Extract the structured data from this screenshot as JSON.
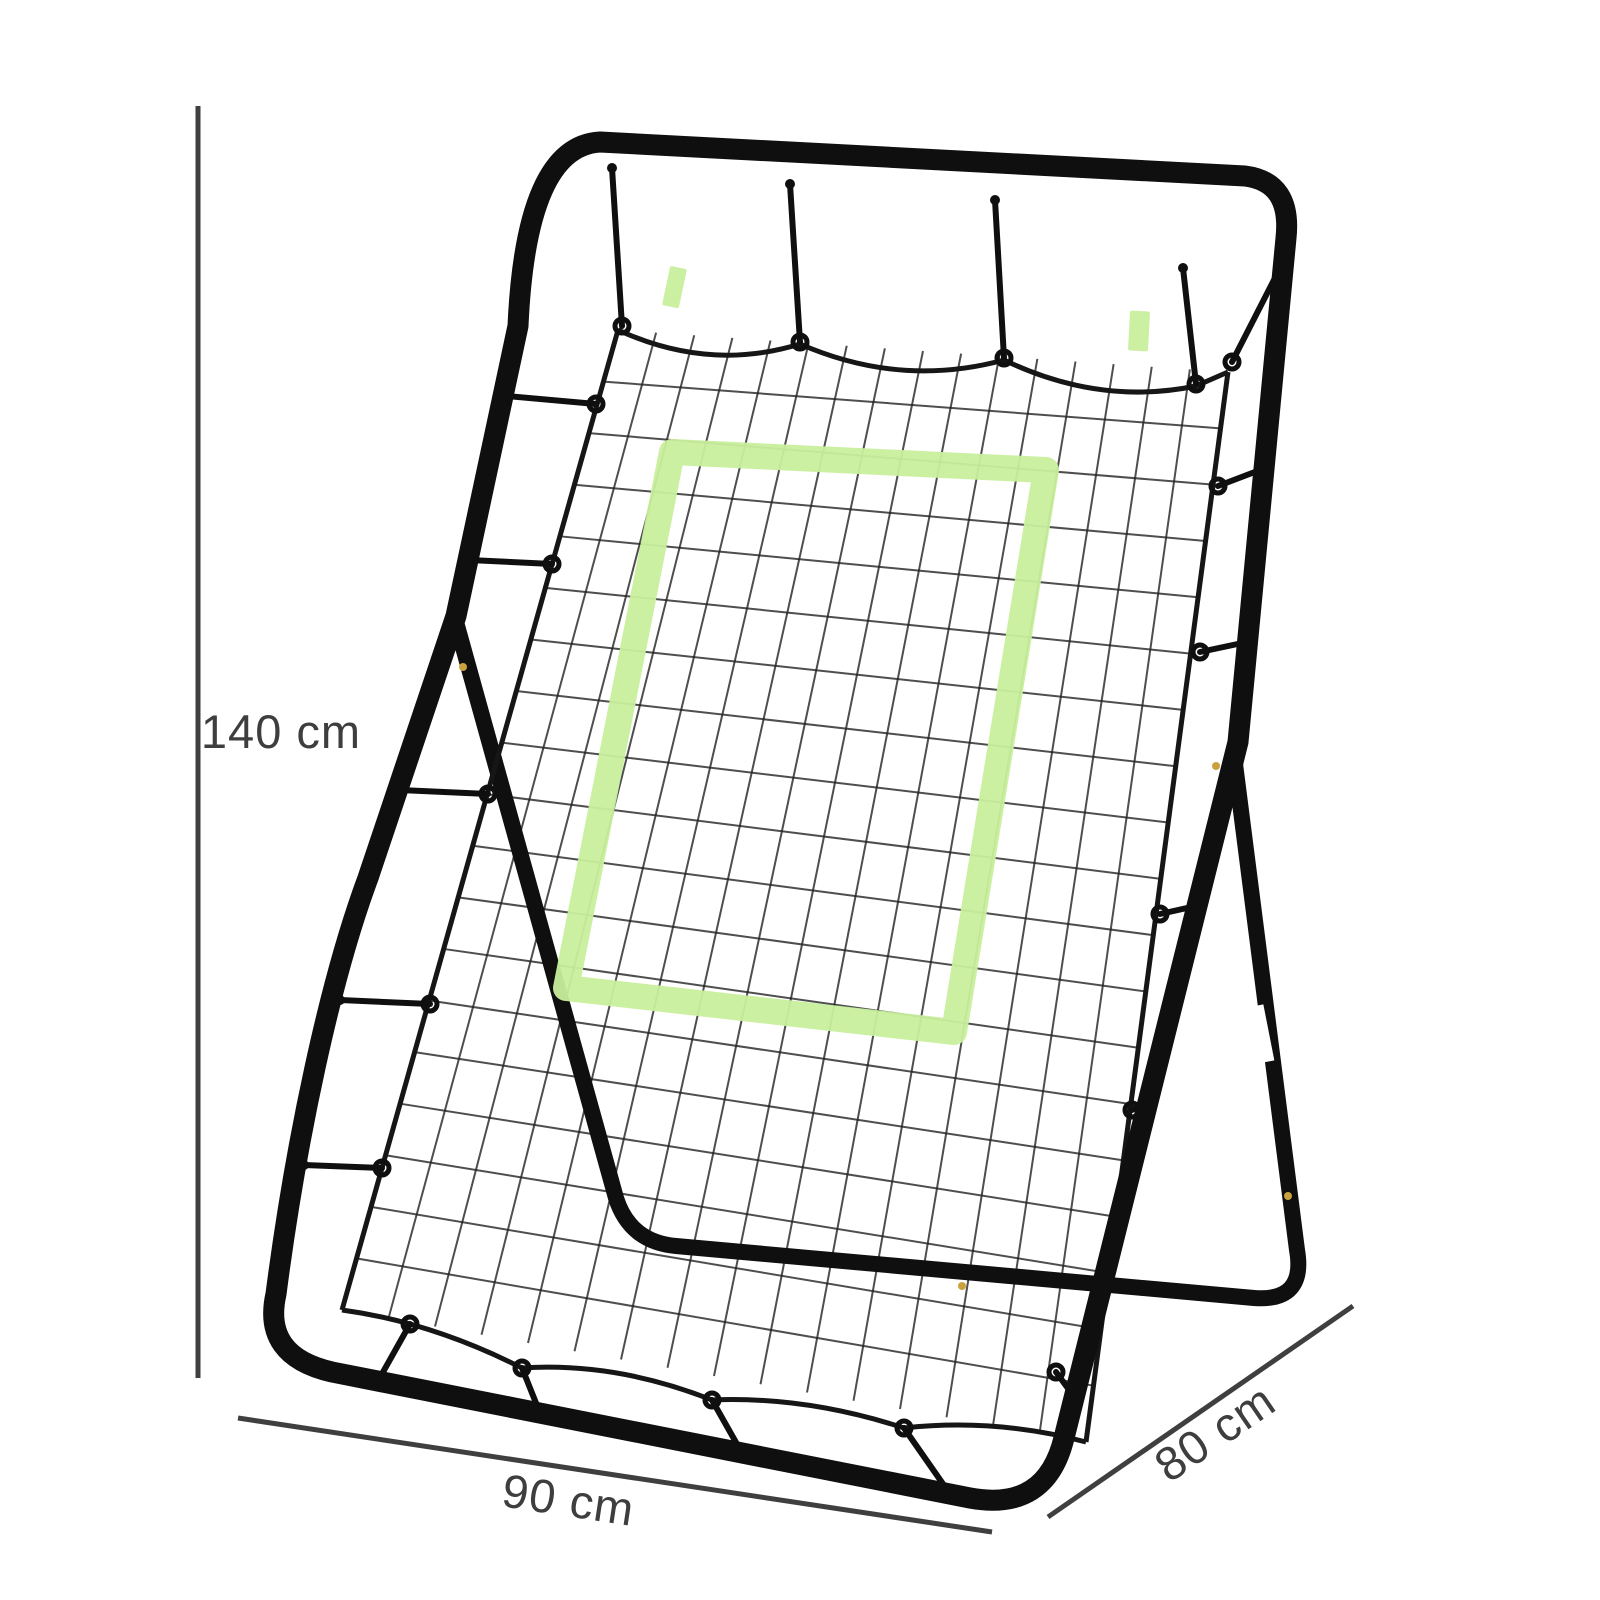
{
  "background": "#ffffff",
  "dimensions": {
    "height": {
      "label": "140 cm"
    },
    "width": {
      "label": "90 cm"
    },
    "depth": {
      "label": "80 cm"
    },
    "line_color": "#3f3f3f",
    "text_color": "#3e3e3e"
  },
  "product": {
    "frame_color": "#0f0f0f",
    "net_color": "#222222",
    "net_border_color": "#161616",
    "target_color": "#c9ef9d",
    "band_color": "#ffffff",
    "screw_color": "#c9a23d"
  }
}
